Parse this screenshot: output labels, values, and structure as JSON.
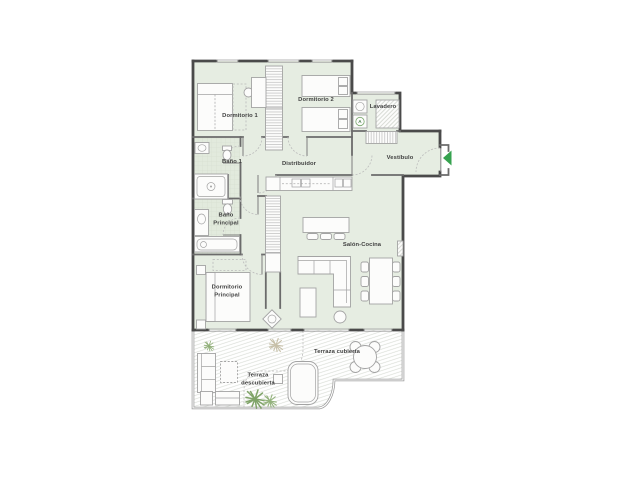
{
  "plan_title": "apartment-floor-plan",
  "rooms": [
    {
      "id": "dormitorio-1",
      "label": "Dormitorio 1"
    },
    {
      "id": "dormitorio-2",
      "label": "Dormitorio 2"
    },
    {
      "id": "lavadero",
      "label": "Lavadero"
    },
    {
      "id": "vestibulo",
      "label": "Vestíbulo"
    },
    {
      "id": "bano-1",
      "label": "Baño 1"
    },
    {
      "id": "distribuidor",
      "label": "Distribuidor"
    },
    {
      "id": "bano-principal",
      "label": "Baño Principal"
    },
    {
      "id": "dormitorio-principal",
      "label": "Dormitorio Principal"
    },
    {
      "id": "salon-cocina",
      "label": "Salón-Cocina"
    },
    {
      "id": "terraza-cubierta",
      "label": "Terraza cubierta"
    },
    {
      "id": "terraza-descubierta",
      "label": "Terraza descubierta"
    }
  ],
  "appliance_label": "A",
  "colors": {
    "floor_green": "#e6ede2",
    "bath_floor": "#e2eadd",
    "wall_dark": "#4a4a4a",
    "wall_mid": "#6b6b6b",
    "furniture_line": "#a3a3a3",
    "accent_green": "#36a24f",
    "plant_green": "#8fae77",
    "plant_dark_green": "#7fa368",
    "plant_tan": "#c7c0a9",
    "hatch_gray": "#d9ddd6"
  }
}
